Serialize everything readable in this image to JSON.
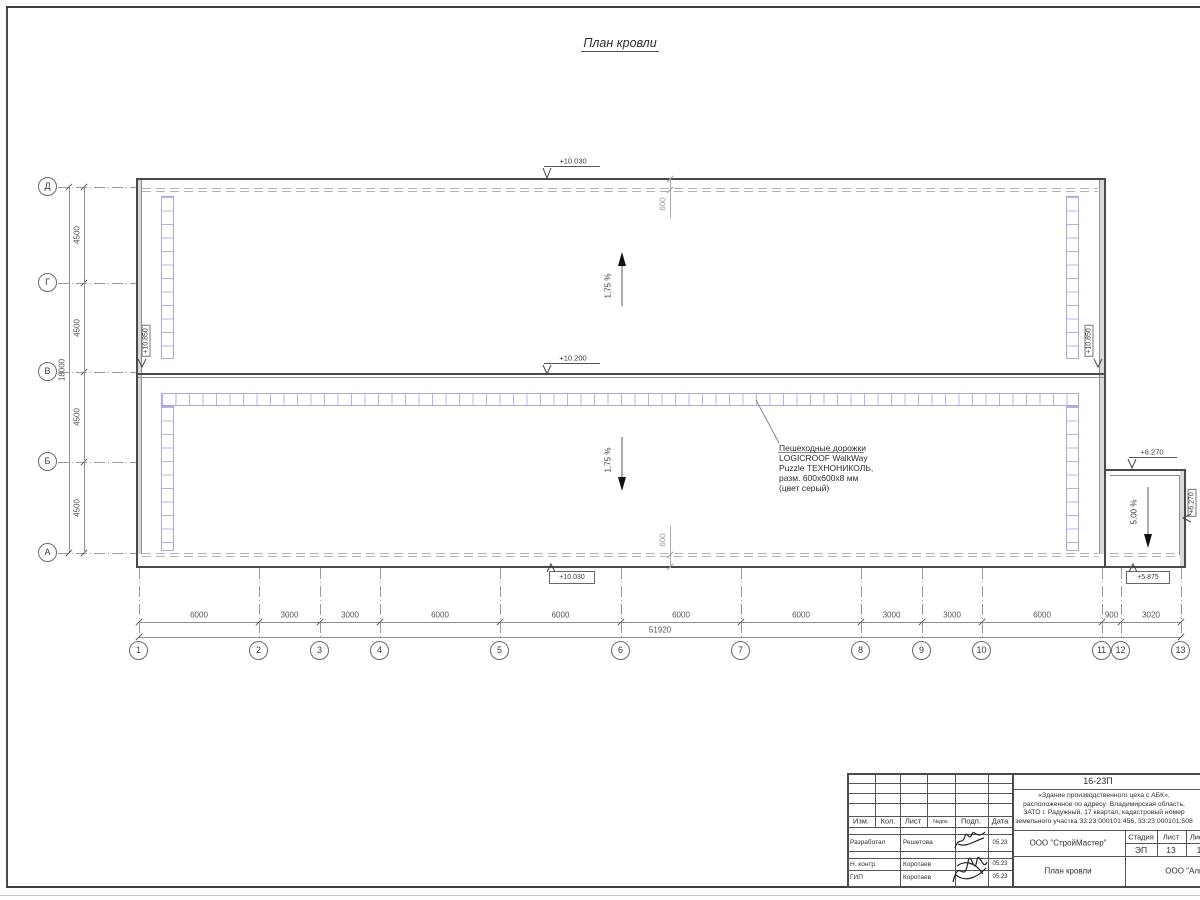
{
  "sheet": {
    "title": "План кровли"
  },
  "grid": {
    "row_labels": [
      "Д",
      "Г",
      "В",
      "Б",
      "А"
    ],
    "row_dims": [
      "4500",
      "4500",
      "4500",
      "4500"
    ],
    "row_total": "18000",
    "col_labels": [
      "1",
      "2",
      "3",
      "4",
      "5",
      "6",
      "7",
      "8",
      "9",
      "10",
      "11",
      "12",
      "13"
    ],
    "col_dims": [
      "6000",
      "3000",
      "3000",
      "6000",
      "6000",
      "6000",
      "6000",
      "3000",
      "3000",
      "6000",
      "900",
      "3020"
    ],
    "col_total": "51920"
  },
  "elevations": {
    "roof_top": "+10.030",
    "ridge": "+10.200",
    "roof_bottom": "+10.030",
    "parapet_left": "+10.850",
    "parapet_right": "+10.850",
    "annex_top": "+6.270",
    "annex_right": "+6.270",
    "annex_bottom": "+5.875"
  },
  "slopes": {
    "upper": "1,75 %",
    "lower": "1,75 %",
    "annex": "5,00 %"
  },
  "parapet_offsets": {
    "top": "600",
    "bottom": "600"
  },
  "walkway_note": "Пешеходные дорожки\nLOGICROOF WalkWay\nPuzzle ТЕХНОНИКОЛЬ,\nразм. 600х600х8 мм\n(цвет серый)",
  "colors": {
    "walkway": "#a9a9e6",
    "outline": "#4a4a4a",
    "dim": "#8f8f8f"
  },
  "title_block": {
    "doc_number": "16-23П",
    "project_description": "«Здание производственного цеха с АБК»,\nрасположенное по адресу: Владимирская область,\nЗАТО г. Радужный, 17 квартал, кадастровый номер\nземельного участка 33:23:000101:456, 33:23:000101:508",
    "organization": "ООО \"СтройМастер\"",
    "sheet_name": "План кровли",
    "contractor": "ООО \"Альянс\"",
    "stage_label": "Стадия",
    "sheet_label": "Лист",
    "sheets_label": "Листов",
    "stage_value": "ЭП",
    "sheet_value": "13",
    "sheets_value": "1",
    "columns": [
      "Изм.",
      "Кол.",
      "Лист",
      "№док.",
      "Подп.",
      "Дата"
    ],
    "roles": [
      {
        "role": "Разработал",
        "name": "Решетова",
        "date": "05.23"
      },
      {
        "role": "Н. контр.",
        "name": "Коротаев",
        "date": "05.23"
      },
      {
        "role": "ГИП",
        "name": "Коротаев",
        "date": "05.23"
      }
    ]
  }
}
